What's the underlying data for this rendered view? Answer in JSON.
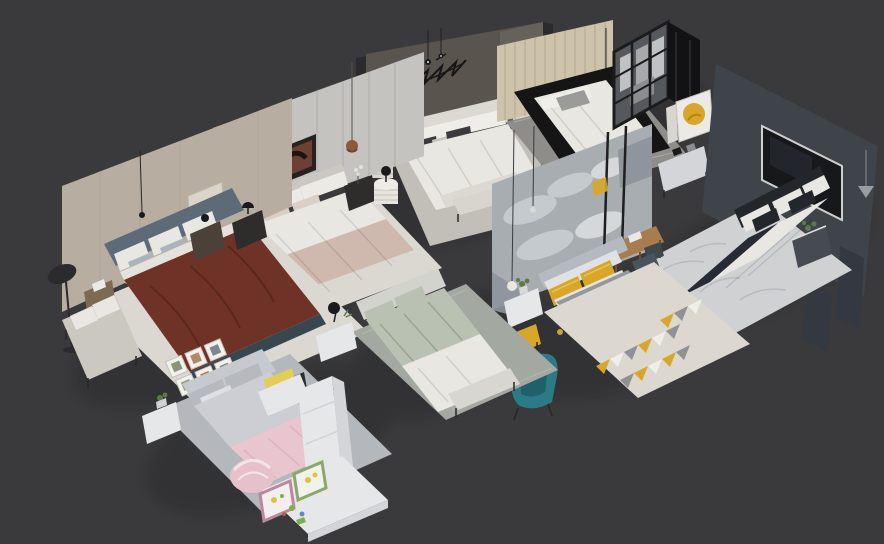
{
  "image": {
    "kind": "3d-render-overview",
    "description": "Isometric 3D render of eight staged bedroom scene models arranged diagonally on a dark gray studio background; no text is visible in the image"
  },
  "colors": {
    "bg": "#3a3a3c",
    "shadow": "#0b0b0c",
    "wallTaupeA": "#59544e",
    "wallTaupeA2": "#666159",
    "darkPanel": "#2b2b2d",
    "rugGrayA": "#c2bfb8",
    "white": "#e9e7e1",
    "offWhite": "#dcd9d2",
    "darkPillow": "#3b3b3d",
    "dark": "#1a1a1c",
    "benchA": "#d8d5ce",
    "wallBeigeB": "#cdc3aa",
    "stripeB": "#a89f8a",
    "rugB": "#8f8d89",
    "bedBlack": "#151515",
    "grayPillow": "#9b9b99",
    "wardrobeGlass": "#55585c",
    "wardrobeSide": "#121214",
    "wardrobeTop": "#242427",
    "clothesLight": "#bfc1c3",
    "clothesMid": "#a7a9ab",
    "wallCharcoalC": "#3f444b",
    "wallCharcoalC2": "#343941",
    "tvScreen": "#16181b",
    "tvFrame": "#cfd0d2",
    "rugMarble": "#d0d1d3",
    "marbleVein": "#b3b5b9",
    "darkPillowC": "#23262b",
    "blanketDarkC": "#272c34",
    "nightC": "#464b53",
    "wallGrayD": "#c5c3c0",
    "wallGrayD2": "#b2b0ad",
    "panelSeam": "#a9a7a4",
    "artFrame": "#262220",
    "artBrown": "#6e4034",
    "copper": "#8a5a3a",
    "furnDark": "#2f2d2b",
    "blanketPinkD": "#cfb9ae",
    "rugLight": "#dbd8d1",
    "wallBeigeF": "#b7ada0",
    "headboardBlue": "#5d6b78",
    "pillowBlue": "#aab4bd",
    "maroon": "#6e3227",
    "maroonFold": "#5a281f",
    "bedBaseTeal": "#37474f",
    "woodNight": "#7d6a52",
    "benchF": "#cbc8c0",
    "frameWhite": "#f2f1ed",
    "wallMuralE": "#a8adb2",
    "cloud": "#c9ced2",
    "cloudBright": "#d9dde0",
    "muralDark": "#8d939a",
    "yellow": "#d9a728",
    "yellowHi": "#ecc250",
    "deskWood": "#a97c4f",
    "deskLeg": "#6e4f33",
    "chairDark": "#3e4850",
    "chairDark2": "#4a545c",
    "headboardE": "#b5bac0",
    "bedGrayE": "#9298a0",
    "blanketGrayE": "#62666d",
    "rugBaseE": "#dcd8d0",
    "triGray": "#8f9195",
    "triWhite": "#f0eee8",
    "whiteFurn": "#e6e7e9",
    "whiteFurn2": "#d3d5d8",
    "plantGreen": "#5d7a4a",
    "teal": "#2a7b85",
    "tealDark": "#206069",
    "sage": "#b9c2b2",
    "sageFold": "#9aa494",
    "headboardH": "#d3d3cd",
    "rugH": "#a3a8a1",
    "benchH": "#d8d6d1",
    "rugG": "#b4b7bb",
    "headboardG": "#c6c9cd",
    "grayPillowG": "#b6b9be",
    "quiltG": "#ccced3",
    "pink": "#e9c6cf",
    "pinkDeep": "#e0b3c0",
    "domePink": "#e6c0cb",
    "yellowCushion": "#e3cd52",
    "frameGreen": "#8aa86a",
    "frameMauve": "#b98a9e",
    "toyYellow": "#e0c23c",
    "toyGreen": "#7cb24d",
    "toyBlue": "#5a8fc0",
    "toyRed": "#c05a5a"
  },
  "scenes": [
    {
      "id": "branch-art-bedroom",
      "label": "White upholstered bed, dark taupe wall with black branch wall art, drum side tables"
    },
    {
      "id": "black-bed-wardrobe",
      "label": "Black platform bed with white bedding, beige slatted wall, black-framed glass wardrobe"
    },
    {
      "id": "tv-wall-bedroom",
      "label": "White bed with dark blanket stripe, charcoal media wall with inset TV, marble rug"
    },
    {
      "id": "gray-panel-bedroom",
      "label": "Cream bed with blush throw, paneled gray wall with framed abstract art, copper pendant"
    },
    {
      "id": "maroon-bed-bedroom",
      "label": "Blue-gray bed with maroon duvet, beige wall, floor lamp, bench and botanical print grid"
    },
    {
      "id": "mural-bedroom",
      "label": "Gray bed with yellow pillows, cloud mural wall, geometric rug, desk, yellow stool, teal armchair"
    },
    {
      "id": "sage-bedroom",
      "label": "Sage green bed with white foot blanket, floating nightstand, gray rug"
    },
    {
      "id": "pink-kids-bedroom",
      "label": "Pink and gray kids bed, white desk and wardrobe unit, play tent and toys"
    }
  ]
}
